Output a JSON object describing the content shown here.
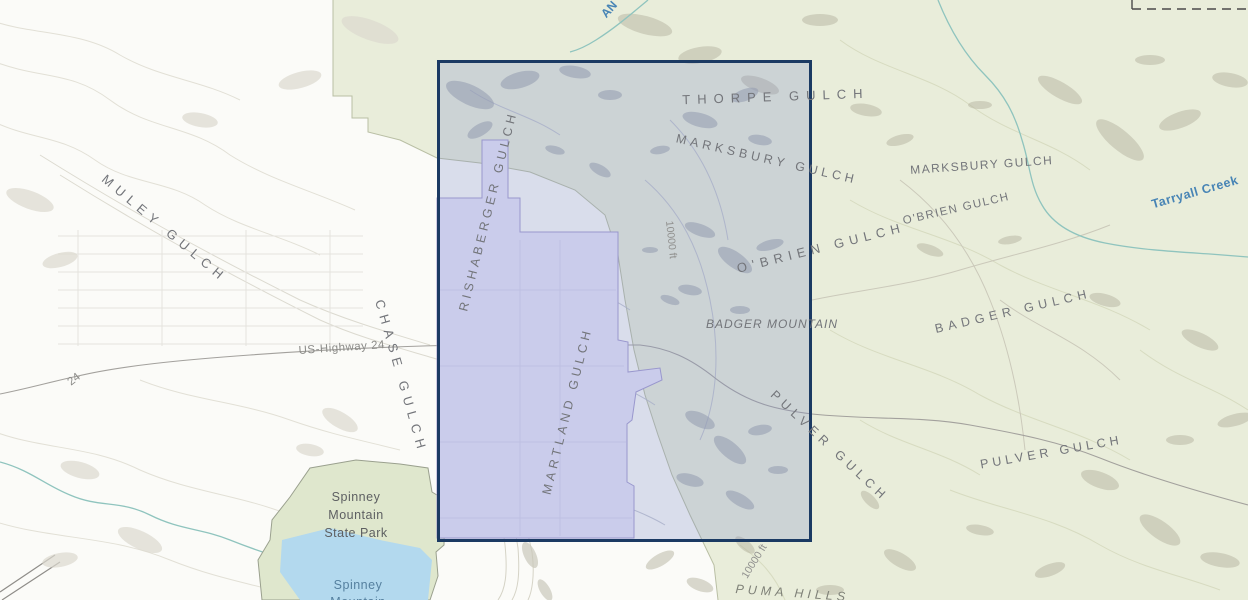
{
  "map": {
    "colors": {
      "background": "#fbfbf8",
      "forest": "#e9edda",
      "forest_boundary": "#b9bfa4",
      "water": "#b3d9ee",
      "creek": "#8fc4be",
      "park": "#dfe7cd",
      "park_border": "#9aa08e",
      "parcel_fill": "#e6e4f8",
      "parcel_border": "#a49bd0",
      "selection_fill": "rgba(127,140,200,0.27)",
      "selection_border": "#1b3a63",
      "road": "#a3a19d",
      "dashed_boundary": "#4a4a4a",
      "label_gray": "#73757a",
      "label_blue": "#4784b5"
    },
    "selection_box": {
      "x": 437,
      "y": 60,
      "width": 375,
      "height": 482
    },
    "labels": [
      {
        "id": "muley-gulch",
        "text": "MULEY GULCH",
        "x": 162,
        "y": 232,
        "r": 40,
        "s": 13,
        "ls": 6
      },
      {
        "id": "chase-gulch",
        "text": "CHASE GULCH",
        "x": 397,
        "y": 378,
        "r": 74,
        "s": 13,
        "ls": 6
      },
      {
        "id": "rishaberger-gulch",
        "text": "RISHABERGER GULCH",
        "x": 492,
        "y": 212,
        "r": -76,
        "s": 12.5,
        "ls": 4
      },
      {
        "id": "martland-gulch",
        "text": "MARTLAND GULCH",
        "x": 571,
        "y": 412,
        "r": -76,
        "s": 12.5,
        "ls": 4
      },
      {
        "id": "thorpe-gulch",
        "text": "THORPE GULCH",
        "x": 776,
        "y": 101,
        "r": -2,
        "s": 13,
        "ls": 7
      },
      {
        "id": "marksbury-gulch-west",
        "text": "MARKSBURY GULCH",
        "x": 766,
        "y": 163,
        "r": 13,
        "s": 12.5,
        "ls": 4
      },
      {
        "id": "marksbury-gulch-east",
        "text": "MARKSBURY GULCH",
        "x": 982,
        "y": 169,
        "r": -4,
        "s": 12,
        "ls": 1.5
      },
      {
        "id": "obrien-gulch-west",
        "text": "O'BRIEN GULCH",
        "x": 822,
        "y": 252,
        "r": -14,
        "s": 13,
        "ls": 5.5
      },
      {
        "id": "obrien-gulch-east",
        "text": "O'BRIEN GULCH",
        "x": 957,
        "y": 212,
        "r": -13,
        "s": 11.5,
        "ls": 1.5
      },
      {
        "id": "badger-mountain",
        "text": "BADGER MOUNTAIN",
        "x": 772,
        "y": 328,
        "r": 0,
        "s": 12,
        "ls": 1,
        "i": true
      },
      {
        "id": "badger-gulch",
        "text": "BADGER GULCH",
        "x": 1014,
        "y": 315,
        "r": -13,
        "s": 12.5,
        "ls": 5
      },
      {
        "id": "pulver-gulch-west",
        "text": "PULVER GULCH",
        "x": 827,
        "y": 449,
        "r": 43,
        "s": 12.5,
        "ls": 5
      },
      {
        "id": "pulver-gulch-east",
        "text": "PULVER GULCH",
        "x": 1052,
        "y": 456,
        "r": -10,
        "s": 12.5,
        "ls": 4
      },
      {
        "id": "us-highway-24",
        "text": "US-Highway 24",
        "x": 342,
        "y": 351,
        "r": -4,
        "s": 11.5,
        "ls": 0.5,
        "c": "#8b8b88"
      },
      {
        "id": "highway-24-shield",
        "text": "24",
        "x": 76,
        "y": 382,
        "r": -38,
        "s": 11.5,
        "c": "#8b8b88"
      },
      {
        "id": "contour-10000-north",
        "text": "10000 ft",
        "x": 668,
        "y": 240,
        "r": 84,
        "s": 10.5,
        "c": "#90908e"
      },
      {
        "id": "contour-10000-south",
        "text": "10000 ft",
        "x": 757,
        "y": 563,
        "r": -58,
        "s": 10.5,
        "c": "#90908e"
      },
      {
        "id": "tarryall-creek",
        "text": "Tarryall Creek",
        "x": 1196,
        "y": 196,
        "r": -16,
        "s": 12.5,
        "ls": 0.5,
        "c": "#4784b5",
        "fw": "600"
      },
      {
        "id": "creek-partial",
        "text": "AN",
        "x": 612,
        "y": 12,
        "r": -48,
        "s": 12,
        "c": "#4784b5",
        "fw": "600"
      },
      {
        "id": "spinney-park-line1",
        "text": "Spinney",
        "x": 356,
        "y": 501,
        "s": 12.5,
        "c": "#5e6062",
        "ls": 0.5
      },
      {
        "id": "spinney-park-line2",
        "text": "Mountain",
        "x": 356,
        "y": 519,
        "s": 12.5,
        "c": "#5e6062",
        "ls": 0.5
      },
      {
        "id": "spinney-park-line3",
        "text": "State Park",
        "x": 356,
        "y": 537,
        "s": 12.5,
        "c": "#5e6062",
        "ls": 0.5
      },
      {
        "id": "spinney-reservoir-line1",
        "text": "Spinney",
        "x": 358,
        "y": 589,
        "s": 12.5,
        "c": "#55809f",
        "ls": 0.5
      },
      {
        "id": "spinney-reservoir-line2",
        "text": "Mountain",
        "x": 358,
        "y": 606,
        "s": 12.5,
        "c": "#55809f",
        "ls": 0.5
      },
      {
        "id": "puma-hills",
        "text": "PUMA HILLS",
        "x": 792,
        "y": 597,
        "r": 4,
        "s": 12.5,
        "ls": 4,
        "i": true,
        "c": "#7e8077"
      }
    ]
  }
}
